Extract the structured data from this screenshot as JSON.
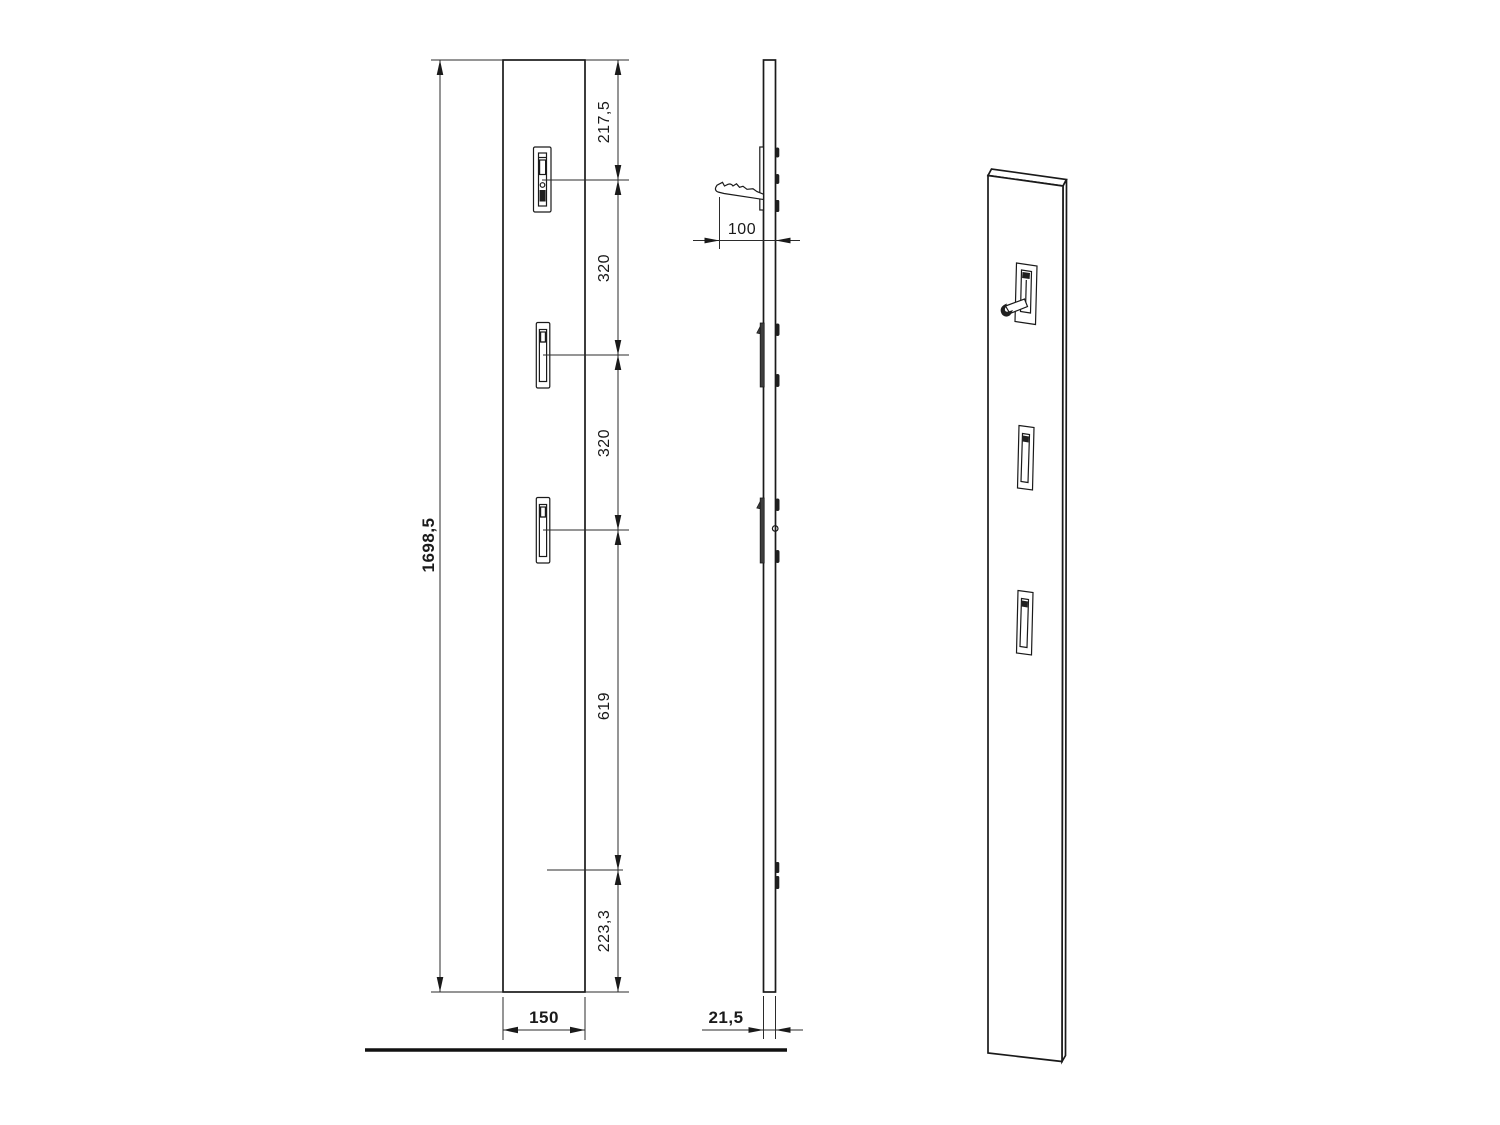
{
  "drawing": {
    "front_view": {
      "overall_height": "1698,5",
      "overall_width": "150",
      "segment_dimensions": [
        "217,5",
        "320",
        "320",
        "619",
        "223,3"
      ]
    },
    "side_view": {
      "hook_projection": "100",
      "panel_thickness": "21,5"
    },
    "colors": {
      "line": "#1a1a1a",
      "background": "#ffffff"
    }
  }
}
